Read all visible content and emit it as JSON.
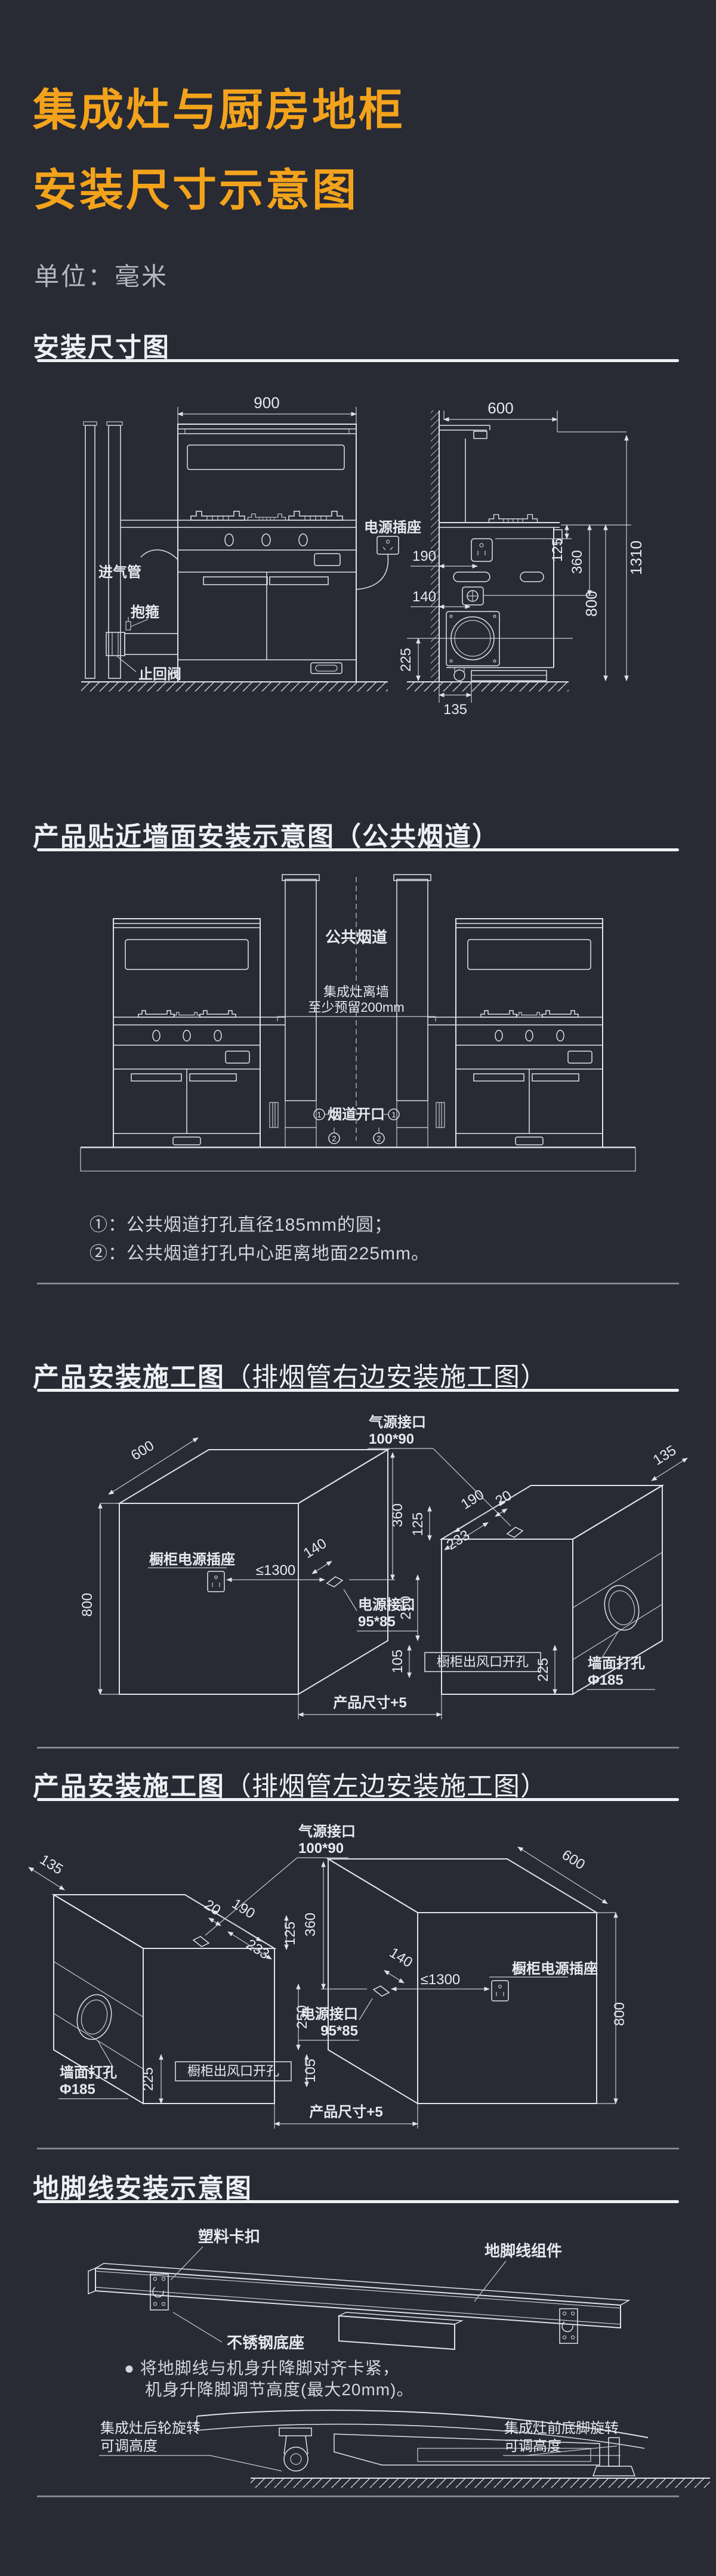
{
  "colors": {
    "background": "#282a34",
    "accent": "#f3a31b",
    "line": "#dfe3e8"
  },
  "icons": {
    "power_socket": "3-pin-plug-icon",
    "flue_marker_1": "circled-1",
    "flue_marker_2": "circled-2"
  },
  "header": {
    "title_line1": "集成灶与厨房地柜",
    "title_line2": "安装尺寸示意图",
    "unit_label": "单位：毫米"
  },
  "s1": {
    "title": "安装尺寸图",
    "front": {
      "dim_width": "900",
      "gas_pipe": "进气管",
      "clamp": "抱箍",
      "check_valve": "止回阀",
      "socket": "电源插座"
    },
    "side": {
      "dim_depth": "600",
      "dim_125": "125",
      "dim_360": "360",
      "dim_800": "800",
      "dim_1310": "1310",
      "dim_190": "190",
      "dim_140": "140",
      "dim_225": "225",
      "dim_135": "135"
    }
  },
  "s2": {
    "title": "产品贴近墙面安装示意图（公共烟道）",
    "flue_label": "公共烟道",
    "gap_line1": "集成灶离墙",
    "gap_line2": "至少预留200mm",
    "opening_label": "烟道开口",
    "marker_1": "1",
    "marker_2": "2",
    "note_1": "①：公共烟道打孔直径185mm的圆；",
    "note_2": "②：公共烟道打孔中心距离地面225mm。"
  },
  "s3": {
    "title_main": "产品安装施工图",
    "title_sub": "（排烟管右边安装施工图）",
    "dim_600": "600",
    "dim_800": "800",
    "dim_360": "360",
    "dim_140": "140",
    "dim_1300": "≤1300",
    "cabinet_socket": "橱柜电源插座",
    "power_port_1": "电源接口",
    "power_port_2": "95*85",
    "gas_port_1": "气源接口",
    "gas_port_2": "100*90",
    "dim_190": "190",
    "dim_125": "125",
    "dim_233": "233",
    "dim_20": "20",
    "dim_135": "135",
    "dim_250": "250",
    "dim_105": "105",
    "dim_225": "225",
    "outlet_label": "橱柜出风口开孔",
    "wall_hole_1": "墙面打孔",
    "wall_hole_2": "Φ185",
    "product_dim": "产品尺寸+5"
  },
  "s4": {
    "title_main": "产品安装施工图",
    "title_sub": "（排烟管左边安装施工图）",
    "dim_600": "600",
    "dim_800": "800",
    "dim_360": "360",
    "dim_140": "140",
    "dim_1300": "≤1300",
    "cabinet_socket": "橱柜电源插座",
    "power_port_1": "电源接口",
    "power_port_2": "95*85",
    "gas_port_1": "气源接口",
    "gas_port_2": "100*90",
    "dim_190": "190",
    "dim_125": "125",
    "dim_233": "233",
    "dim_20": "20",
    "dim_135": "135",
    "dim_250": "250",
    "dim_105": "105",
    "dim_225": "225",
    "outlet_label": "橱柜出风口开孔",
    "wall_hole_1": "墙面打孔",
    "wall_hole_2": "Φ185",
    "product_dim": "产品尺寸+5"
  },
  "s5": {
    "title": "地脚线安装示意图",
    "clip_label": "塑料卡扣",
    "assembly_label": "地脚线组件",
    "base_label": "不锈钢底座",
    "bullet": "●",
    "note_1": "将地脚线与机身升降脚对齐卡紧，",
    "note_2": "机身升降脚调节高度(最大20mm)。",
    "rear_1": "集成灶后轮旋转",
    "rear_2": "可调高度",
    "front_1": "集成灶前底脚旋转",
    "front_2": "可调高度"
  }
}
